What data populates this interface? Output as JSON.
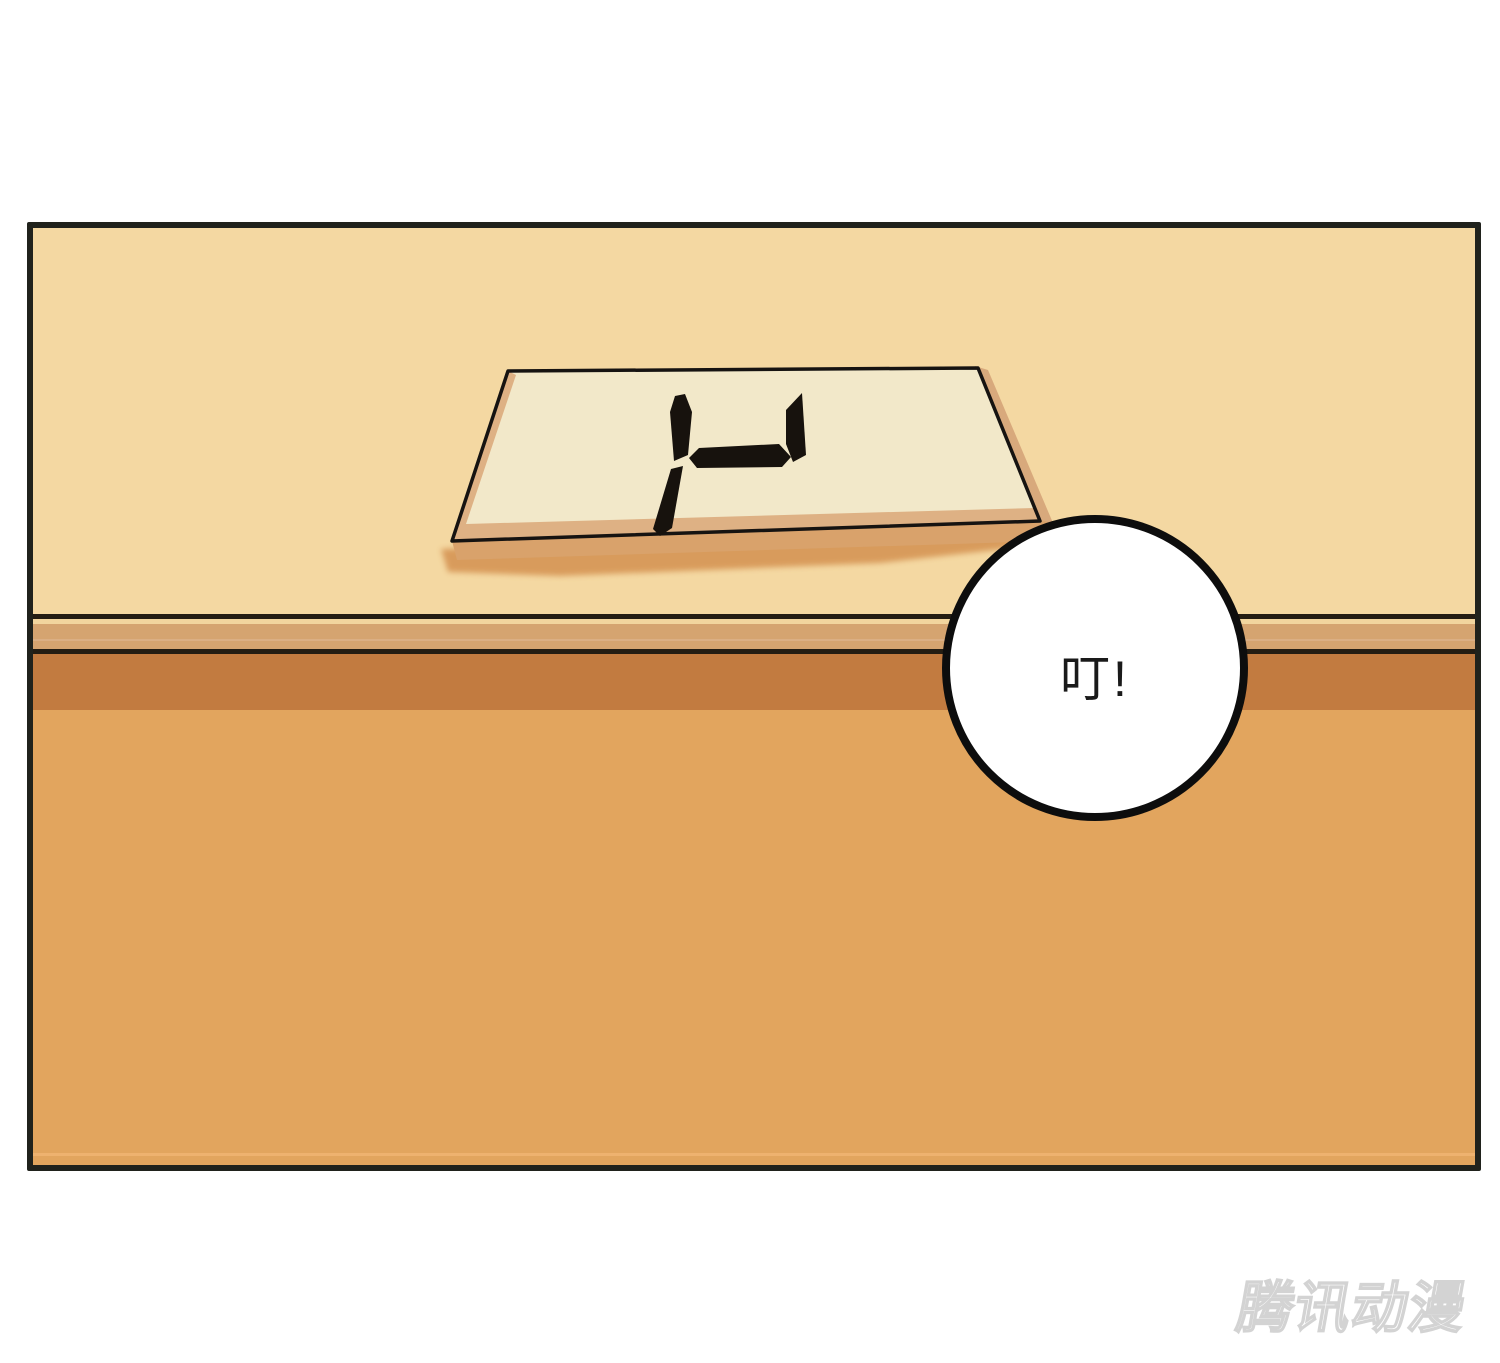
{
  "scene": {
    "type": "comic-panel",
    "description": "A pale number tablet lying flat on a wooden table edge, seen in perspective; a round sound-effect bubble overlaps the table edge.",
    "speech_bubble": {
      "text": "叮!"
    },
    "number_board": {
      "symbol": "seven-segment-digit",
      "segments": [
        "upper-left-vertical",
        "lower-left-vertical",
        "middle-horizontal",
        "upper-right-vertical"
      ]
    },
    "watermark": {
      "text": "腾讯动漫"
    }
  },
  "colors": {
    "page_bg": "#ffffff",
    "panel_border": "#20221c",
    "wall": "#f4d8a2",
    "edge_line": "#241d13",
    "edge_highlight": "#f2d59e",
    "edge_mid": "#d5a470",
    "edge_mid_line": "#dcb189",
    "table_apron": "#c27b40",
    "table_front": "#e2a55e",
    "table_front_line": "#f0b472",
    "board_top": "#f2e8c9",
    "board_bevel": "#dcab7c",
    "board_side": "#d8a97c",
    "board_front": "#d9a26b",
    "board_shadow": "#d69554",
    "board_outline": "#161311",
    "symbol": "#17120d",
    "bubble_fill": "#ffffff",
    "bubble_stroke": "#0d0d0d",
    "bubble_text": "#1a1a1a",
    "watermark_fill": "#ffffff",
    "watermark_stroke": "#d3d3d3"
  }
}
